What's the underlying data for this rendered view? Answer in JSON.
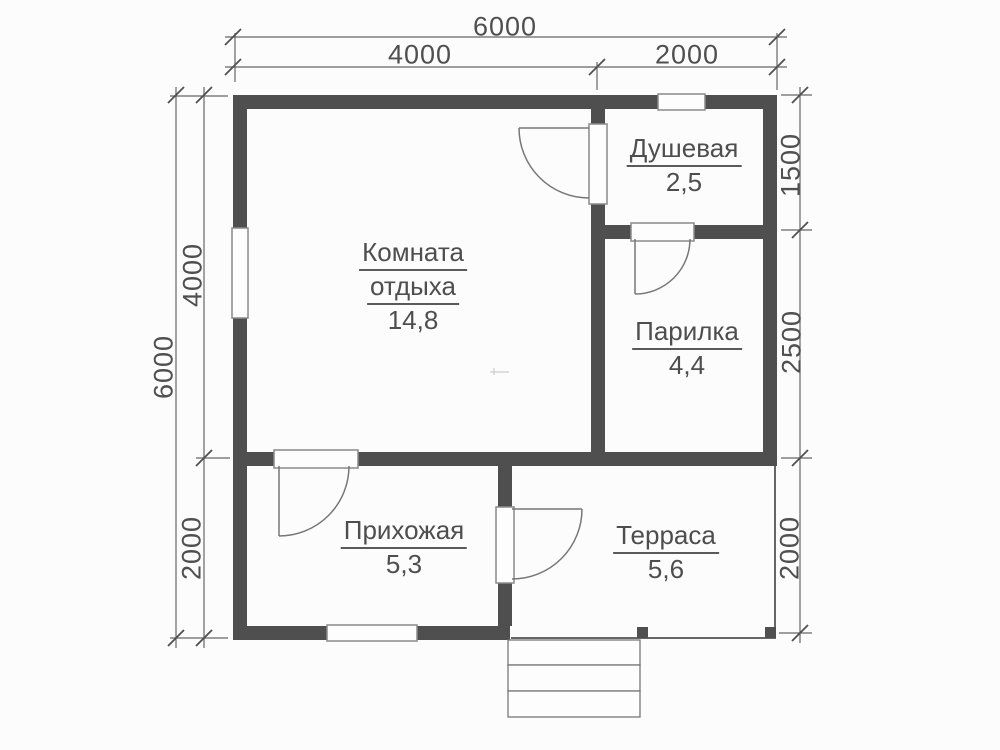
{
  "rooms": {
    "lounge": {
      "name_line1": "Комната",
      "name_line2": "отдыха",
      "area": "14,8"
    },
    "shower": {
      "name": "Душевая",
      "area": "2,5"
    },
    "steam": {
      "name": "Парилка",
      "area": "4,4"
    },
    "hallway": {
      "name": "Прихожая",
      "area": "5,3"
    },
    "terrace": {
      "name": "Терраса",
      "area": "5,6"
    }
  },
  "dimensions": {
    "top": {
      "total": "6000",
      "left_span": "4000",
      "right_span": "2000"
    },
    "left": {
      "total": "6000",
      "upper_span": "4000",
      "lower_span": "2000"
    },
    "right": {
      "upper_span": "1500",
      "middle_span": "2500",
      "lower_span": "2000"
    }
  },
  "colors": {
    "wall": "#4f4f4f",
    "thin_line": "#666666",
    "door_line": "#777777",
    "text": "#4e4e4e",
    "background": "#fcfcfc"
  }
}
